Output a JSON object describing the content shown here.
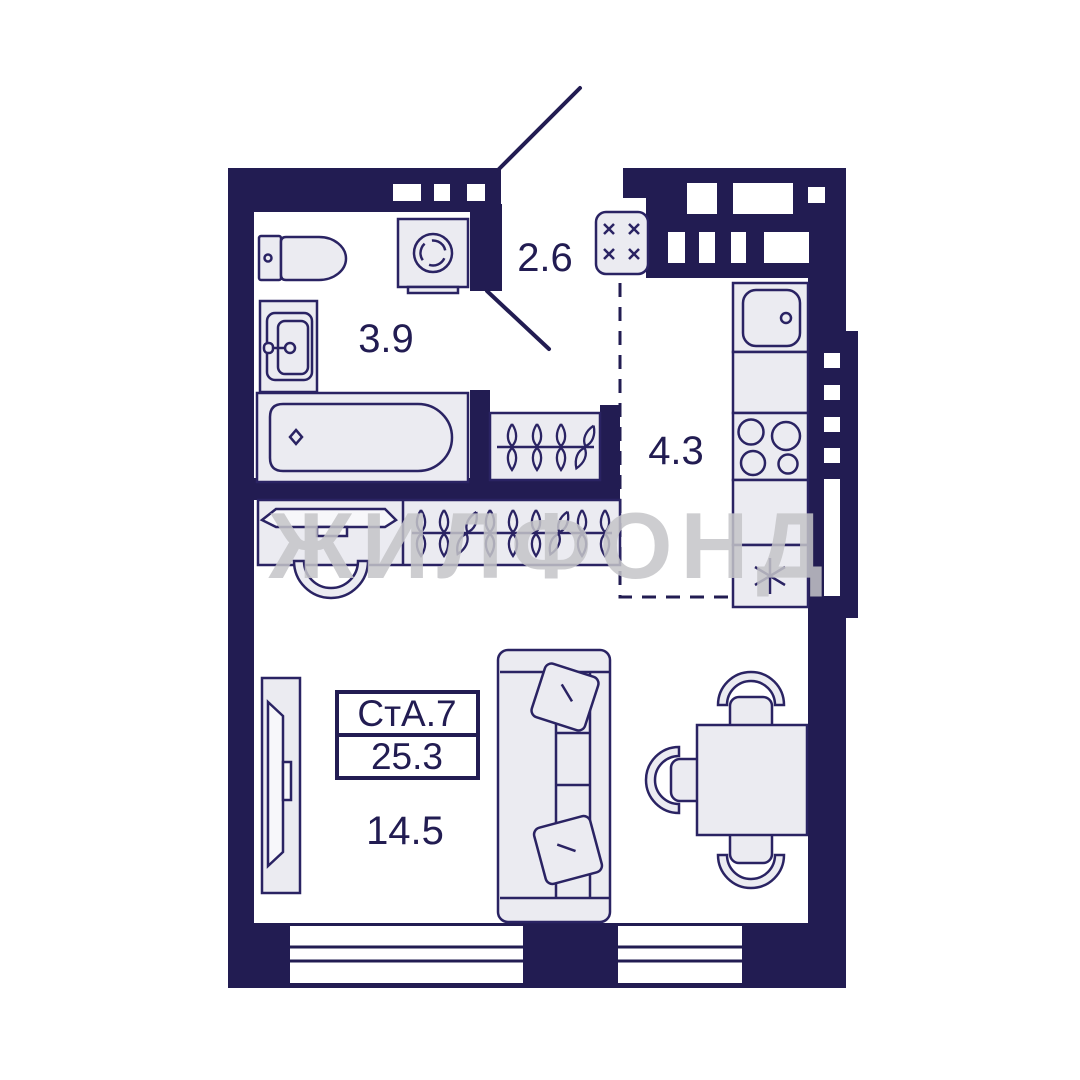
{
  "plan": {
    "type": "apartment-floor-plan",
    "unit": {
      "code": "СтА.7",
      "total_area": "25.3"
    },
    "rooms": {
      "hallway": {
        "area": "2.6"
      },
      "bathroom": {
        "area": "3.9"
      },
      "kitchen": {
        "area": "4.3"
      },
      "living": {
        "area": "14.5"
      }
    },
    "watermark": {
      "text": "ЖИЛФОНД",
      "color": "#c5c5c8"
    },
    "colors": {
      "wall": "#221c52",
      "outline": "#2a2363",
      "furniture_fill": "#ebebf1",
      "floor": "#ffffff"
    },
    "fixtures": [
      "toilet",
      "bathroom-sink",
      "bathtub",
      "washing-machine",
      "electrical-panel",
      "hall-wardrobe-hangers",
      "closet-hangers",
      "dressing-table",
      "dressing-chair",
      "tv",
      "sofa",
      "dining-table",
      "dining-chairs",
      "kitchen-sink",
      "counter",
      "stove",
      "fridge"
    ]
  }
}
